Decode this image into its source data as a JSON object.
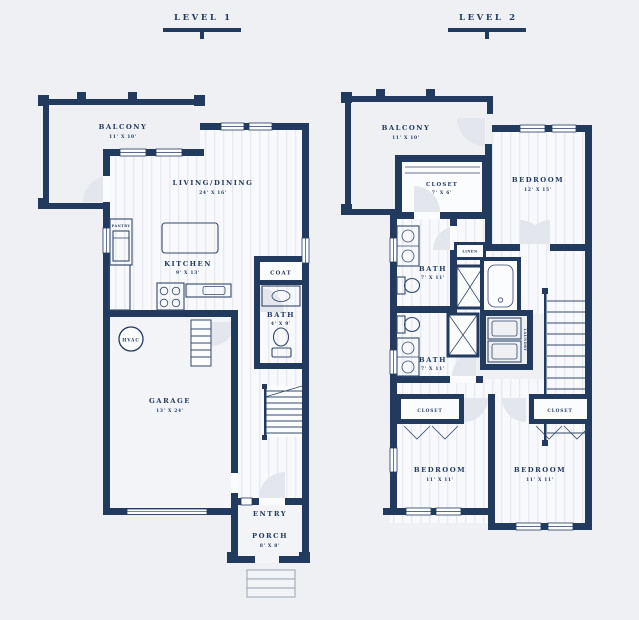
{
  "colors": {
    "background": "#eef0f4",
    "wall_navy": "#223a5e",
    "floor": "#f8f9fc",
    "stripe": "#e7eaf1",
    "door_arc": "#e3e6ec",
    "steps_gray": "#a9b0bd"
  },
  "header": {
    "level1": "LEVEL 1",
    "level2": "LEVEL 2"
  },
  "level1": {
    "balcony": {
      "name": "BALCONY",
      "dims": "11' X 10'"
    },
    "living": {
      "name": "LIVING/DINING",
      "dims": "24' X 16'"
    },
    "kitchen": {
      "name": "KITCHEN",
      "dims": "9' X 13'"
    },
    "pantry": {
      "name": "PANTRY"
    },
    "hvac": {
      "name": "HVAC"
    },
    "coat": {
      "name": "COAT"
    },
    "bath": {
      "name": "BATH",
      "dims": "4' X 9'"
    },
    "garage": {
      "name": "GARAGE",
      "dims": "13' X 24'"
    },
    "entry": {
      "name": "ENTRY"
    },
    "porch": {
      "name": "PORCH",
      "dims": "8' X 8'"
    }
  },
  "level2": {
    "balcony": {
      "name": "BALCONY",
      "dims": "11' X 10'"
    },
    "closet": {
      "name": "CLOSET",
      "dims": "7' X 6'"
    },
    "bedroom1": {
      "name": "BEDROOM",
      "dims": "12' X 15'"
    },
    "bath1": {
      "name": "BATH",
      "dims": "7' X 11'"
    },
    "linen": {
      "name": "LINEN"
    },
    "laundry": {
      "name": "LAUNDRY"
    },
    "bath2": {
      "name": "BATH",
      "dims": "7' X 11'"
    },
    "closet2": {
      "name": "CLOSET"
    },
    "closet3": {
      "name": "CLOSET"
    },
    "bedroom2": {
      "name": "BEDROOM",
      "dims": "11' X 11'"
    },
    "bedroom3": {
      "name": "BEDROOM",
      "dims": "11' X 11'"
    }
  }
}
